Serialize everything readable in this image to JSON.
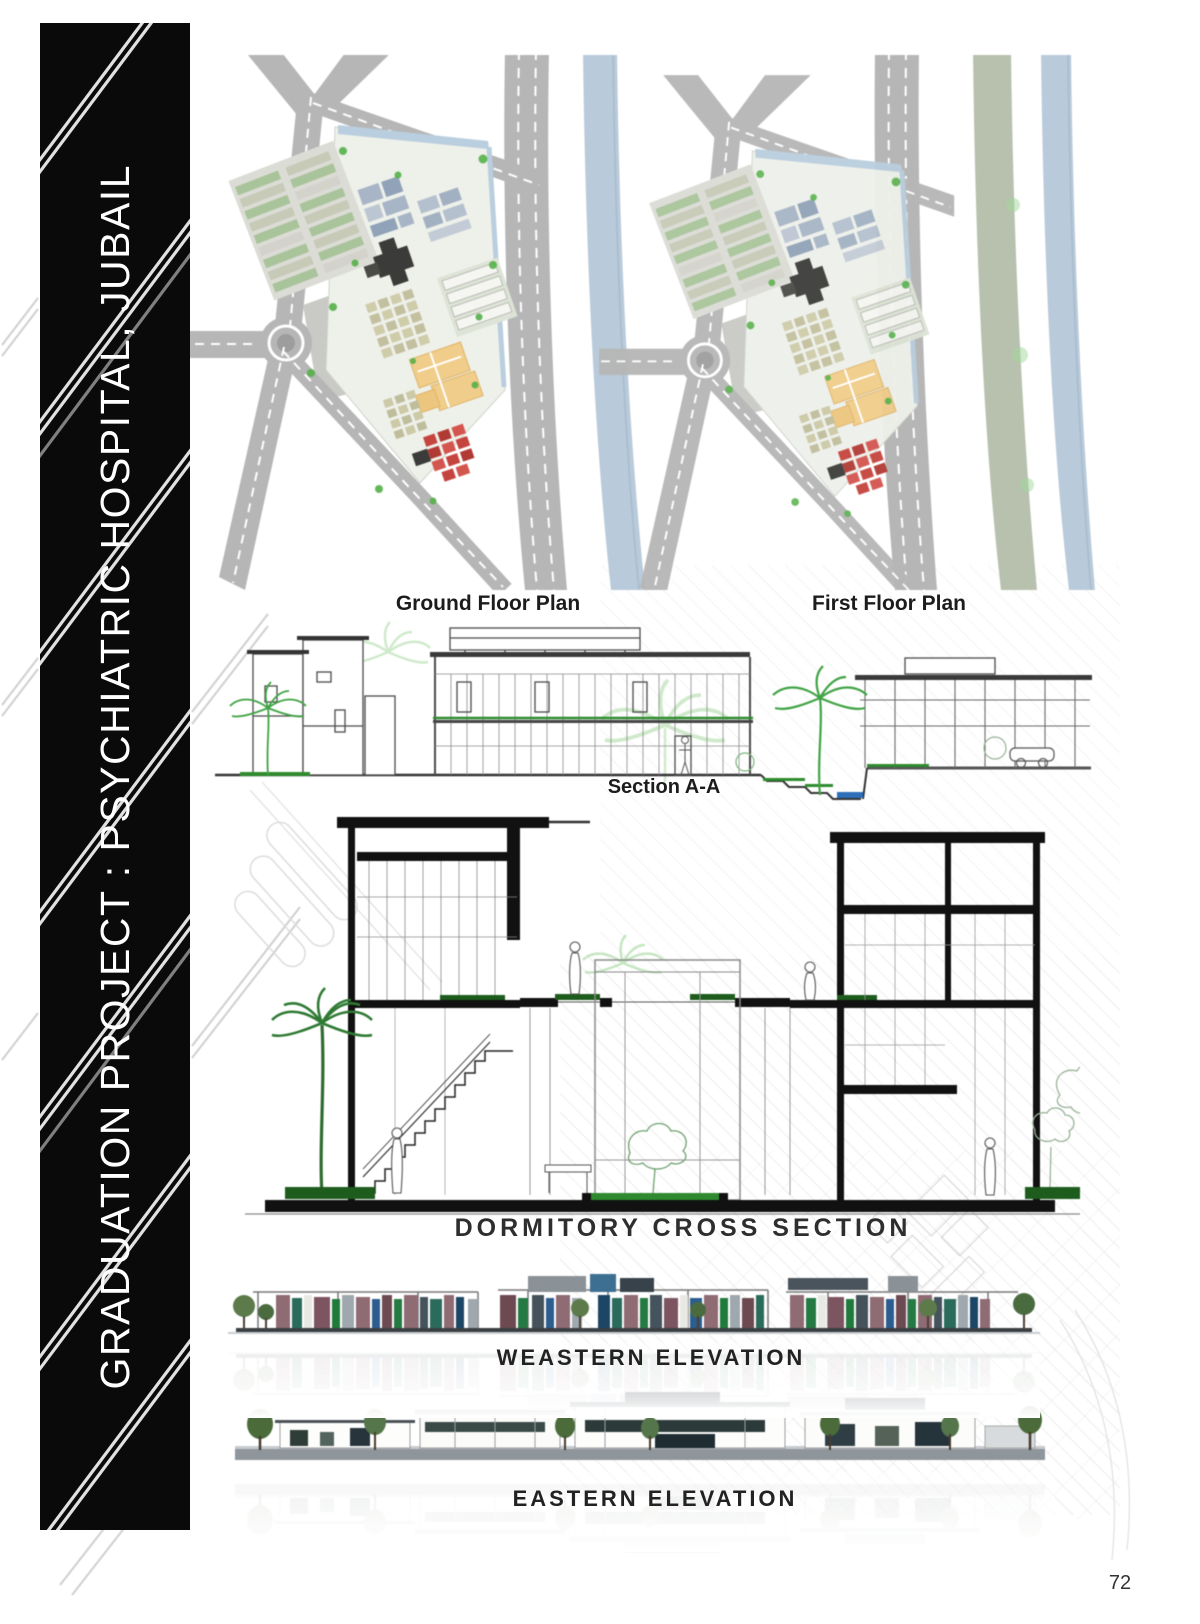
{
  "page": {
    "number": "72"
  },
  "banner": {
    "title": "GRADUATION PROJECT : PSYCHIATRIC HOSPITAL, JUBAIL",
    "bg_color": "#0a0a0a",
    "text_color": "#ffffff"
  },
  "figures": {
    "ground_floor_plan": {
      "label": "Ground Floor Plan"
    },
    "first_floor_plan": {
      "label": "First Floor Plan"
    },
    "section_aa": {
      "label": "Section A-A"
    },
    "dormitory_cross_section": {
      "label": "DORMITORY CROSS SECTION"
    },
    "western_elevation": {
      "label": "WEASTERN ELEVATION"
    },
    "eastern_elevation": {
      "label": "EASTERN ELEVATION"
    }
  },
  "colors": {
    "road_gray": "#b6b6b6",
    "water_blue": "#b9cada",
    "greenbelt_sage": "#b8c1ae",
    "block_blue": "#a7b5c6",
    "block_orange": "#f0cd8a",
    "block_red": "#c6443e",
    "block_dark": "#3b3b39",
    "block_khaki": "#cfccaa",
    "tree_green": "#55b149",
    "section_floor_green": "#2e8b2e",
    "ground_green": "#1d5c1d",
    "pool_blue": "#2d6fba",
    "drawing_ink": "#111111"
  }
}
